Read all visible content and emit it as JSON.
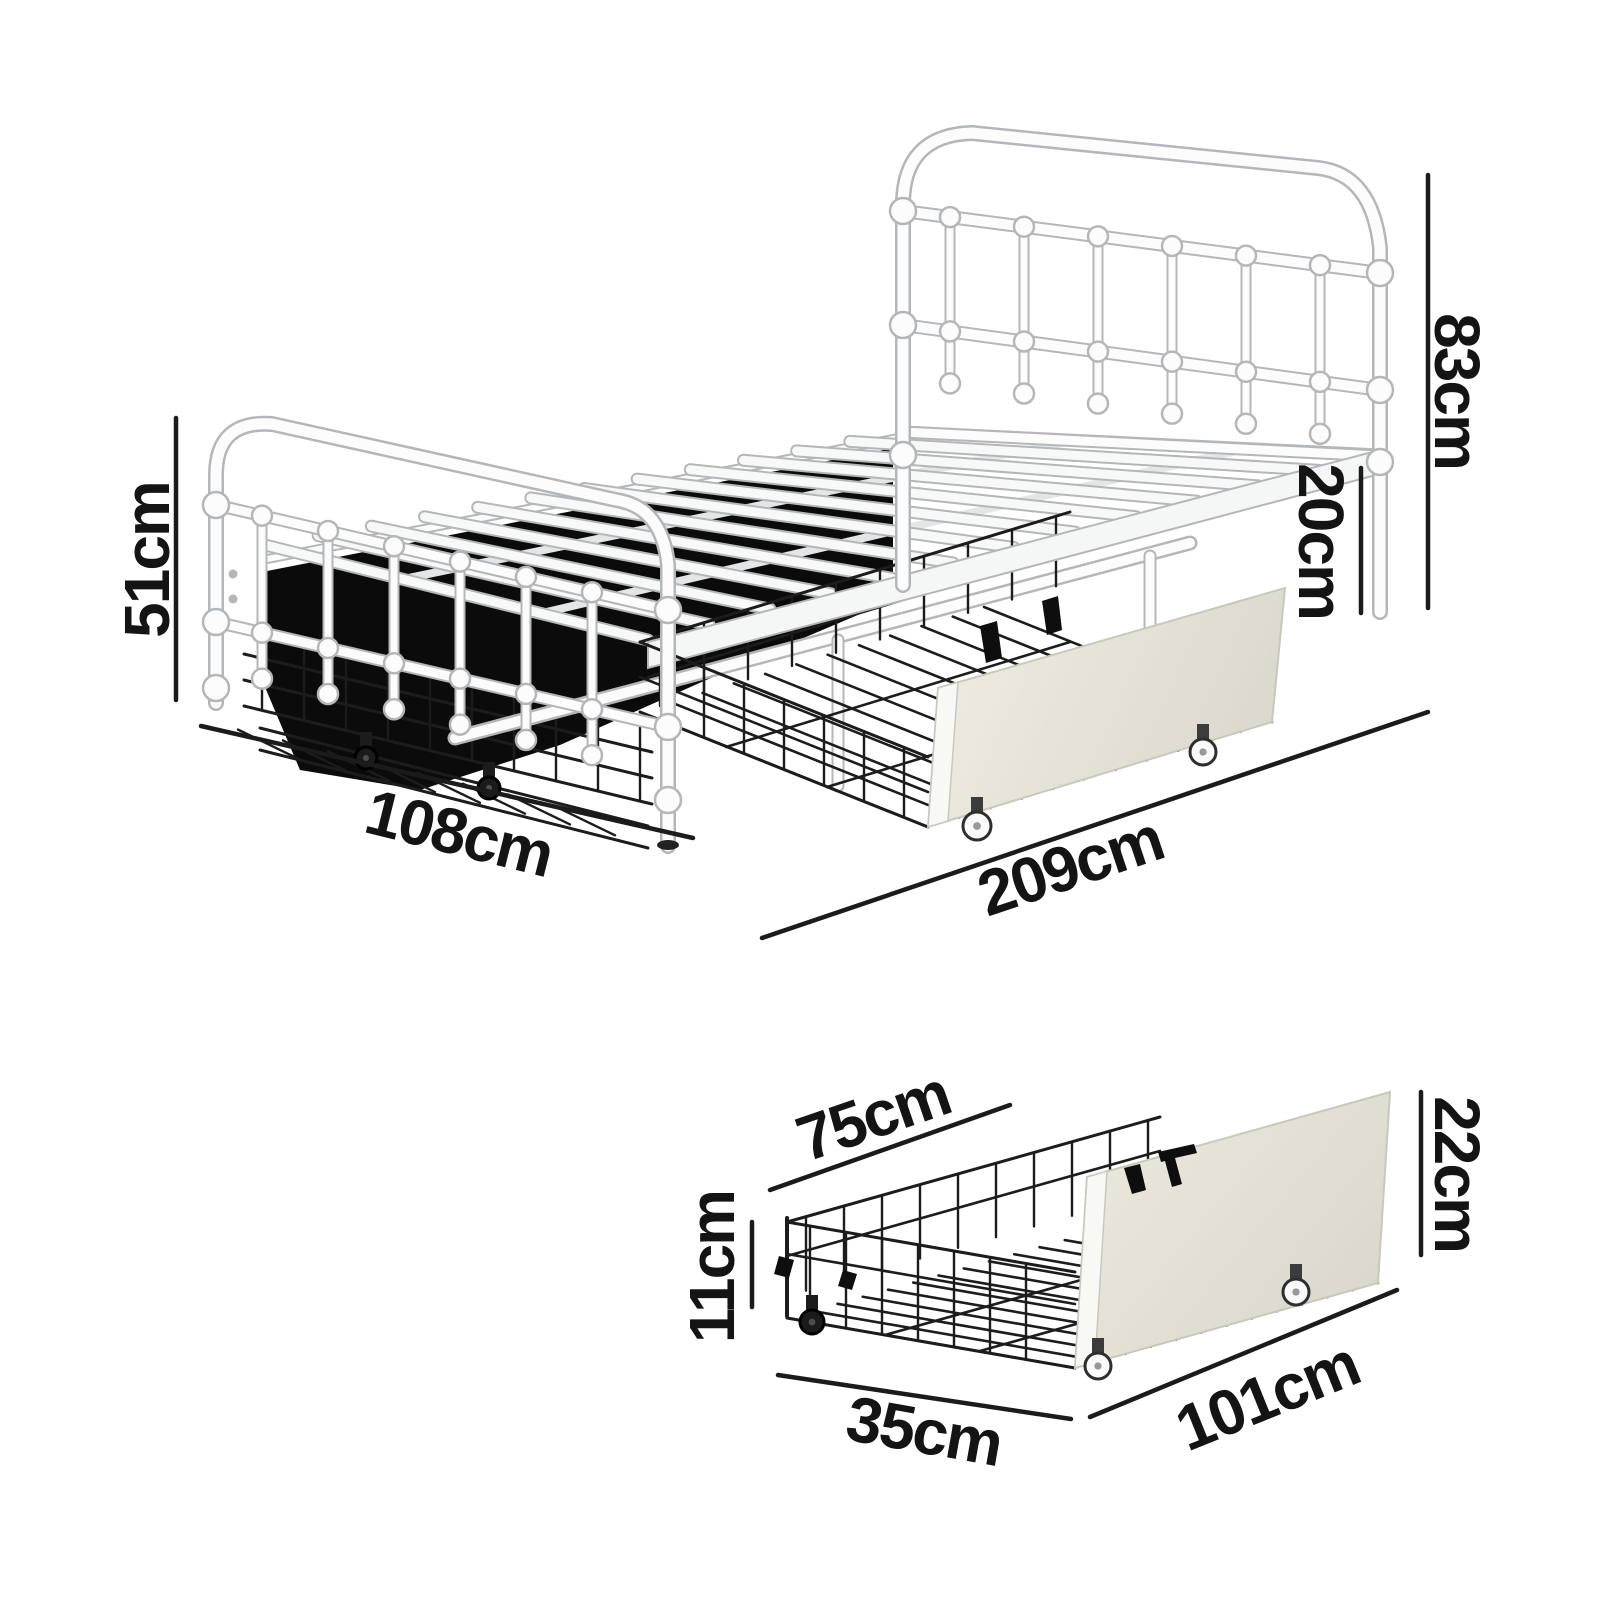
{
  "figure": {
    "kind": "furniture-dimension-diagram",
    "views": [
      "bed-frame-with-underbed-drawers",
      "storage-drawer-detail"
    ]
  },
  "colors": {
    "background": "#ffffff",
    "dimension_text": "#141414",
    "dimension_line": "#1b1b1b",
    "frame_outline": "#b4b7ba",
    "frame_fill": "#fcfcfd",
    "wire_black": "#1c1c1c",
    "under_bed_shadow": "#0b0b0b",
    "drawer_panel_beige": "#e5e3d8"
  },
  "dimensions": {
    "bed": {
      "footboard_height": "51cm",
      "width": "108cm",
      "headboard_height": "83cm",
      "underbed_clearance": "20cm",
      "length": "209cm"
    },
    "drawer": {
      "depth": "75cm",
      "basket_height": "11cm",
      "front_height": "22cm",
      "bottom_width": "35cm",
      "front_width": "101cm"
    }
  }
}
